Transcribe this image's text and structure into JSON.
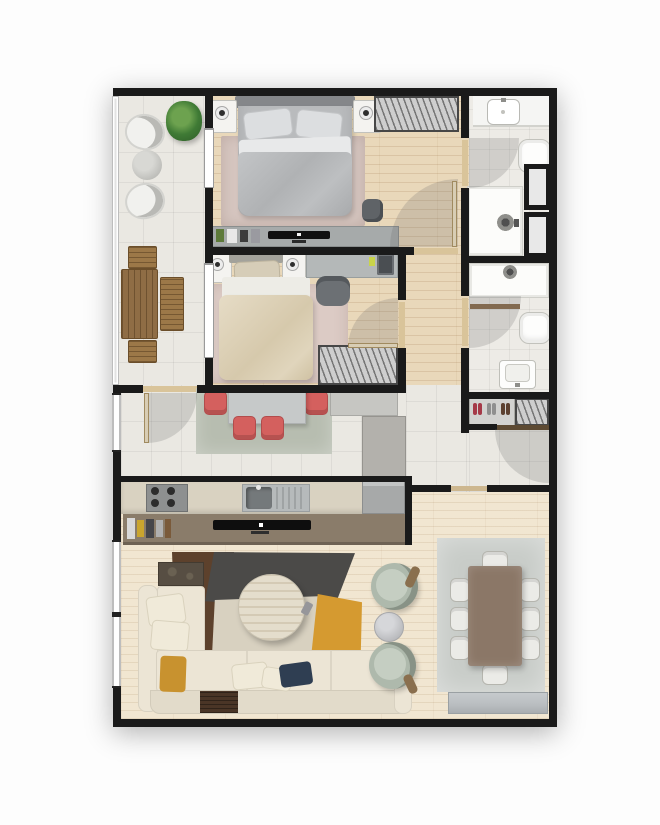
{
  "title": "Apartment floor plan (top-down 3D render)",
  "palette": {
    "wall": "#1a1a1a",
    "wood_bedroom": "#e9d8ba",
    "wood_living": "#f1e6d1",
    "tile": "#eae8e2",
    "tile_bath": "#edebe6",
    "rug_master": "#d6c6c0",
    "rug_bedroom2": "#dccbc5",
    "rug_nook": "#b7bdb0",
    "rug_dining": "#c8ccc8",
    "rug_brown": "#5d412c",
    "rug_charcoal": "#4b4a48",
    "rug_cream": "#d8d1c0",
    "rug_mustard": "#d59a30",
    "sofa": "#ece5d5",
    "island": "#8a7c6a",
    "counter": "#d9d2c1",
    "chair_coral": "#d4605e",
    "armchair_sage": "#aeb9ac",
    "dining_table": "#8b7767",
    "bed_master": "#b9bbbd",
    "bed_single": "#ddd2ba",
    "door_arc": "rgba(105,105,105,0.22)",
    "window": "#ffffff",
    "door_leaf": "#d8cdb4",
    "dark_wood": "#4a3526",
    "cushion_mustard": "#c8922f",
    "cushion_navy": "#2f3e52",
    "plant_green": "#3f7a35",
    "steel": "#b6babb",
    "sideboard": "#b9bdc0",
    "shoe_rack": "#d2d2d0"
  },
  "rooms": [
    {
      "name": "balcony",
      "furniture": [
        "potted-plant",
        "lounge-chair",
        "lounge-chair",
        "round-side-table",
        "wooden-table",
        "bench",
        "bench",
        "bench"
      ]
    },
    {
      "name": "master-bedroom",
      "furniture": [
        "double-bed",
        "nightstand-with-lamp",
        "nightstand-with-lamp",
        "wardrobe",
        "dresser",
        "tv",
        "rug",
        "pouf"
      ]
    },
    {
      "name": "ensuite-bathroom",
      "furniture": [
        "washbasin-counter",
        "toilet",
        "shower",
        "service-shaft",
        "service-shaft"
      ]
    },
    {
      "name": "bedroom-2",
      "furniture": [
        "single-bed",
        "nightstand-with-lamp",
        "nightstand-with-lamp",
        "desk",
        "desk-chair",
        "laptop",
        "wardrobe",
        "rug"
      ]
    },
    {
      "name": "bathroom-2",
      "furniture": [
        "shower",
        "toilet",
        "washbasin"
      ]
    },
    {
      "name": "entry-hall",
      "furniture": [
        "shoe-rack",
        "entrance-door"
      ]
    },
    {
      "name": "dining-nook",
      "furniture": [
        "table",
        "coral-chair",
        "coral-chair",
        "coral-chair",
        "coral-chair",
        "rug",
        "cabinet",
        "tall-cabinet"
      ]
    },
    {
      "name": "kitchen",
      "furniture": [
        "cooktop",
        "sink",
        "refrigerator",
        "island-counter",
        "tv",
        "jars"
      ]
    },
    {
      "name": "living-room",
      "furniture": [
        "sectional-sofa",
        "coffee-table",
        "patchwork-rug",
        "armchair",
        "armchair",
        "side-table",
        "dark-console",
        "tray-table"
      ]
    },
    {
      "name": "dining-room",
      "furniture": [
        "dining-table",
        "dining-chairs-x8",
        "rug",
        "sideboard"
      ]
    }
  ]
}
